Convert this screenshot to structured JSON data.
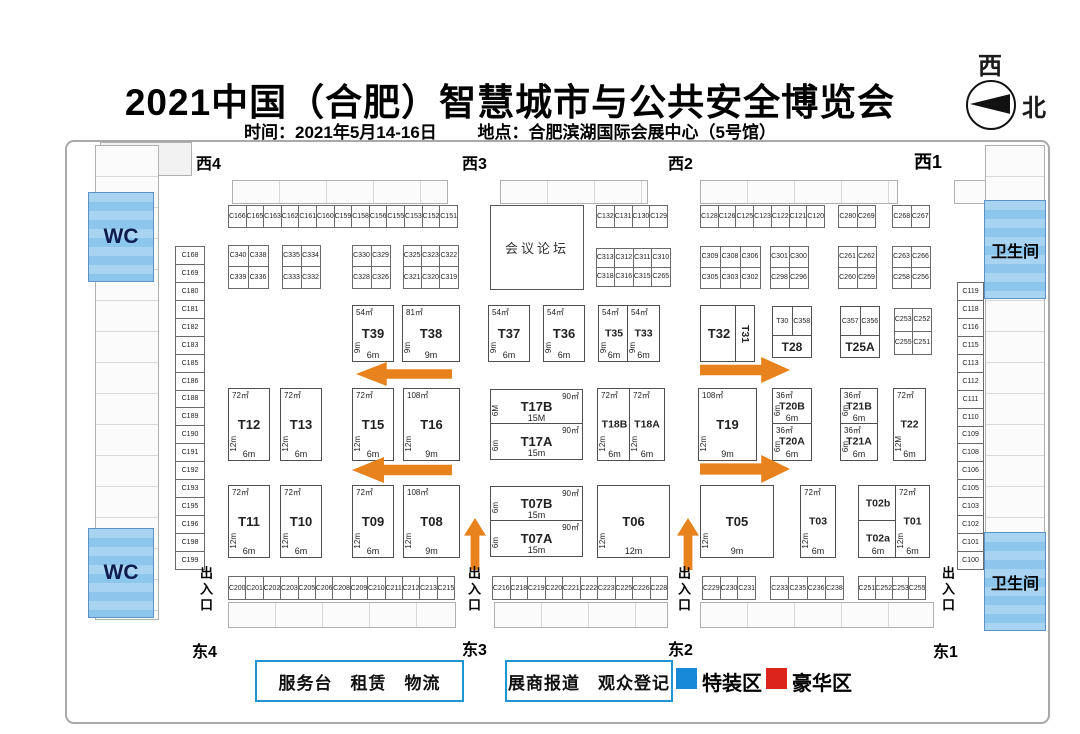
{
  "header": {
    "title": "2021中国（合肥）智慧城市与公共安全博览会",
    "subtitle_time": "时间：2021年5月14-16日",
    "subtitle_place": "地点：合肥滨湖国际会展中心（5号馆）",
    "compass": {
      "west": "西",
      "north": "北"
    }
  },
  "gates": {
    "west4": "西4",
    "west3": "西3",
    "west2": "西2",
    "west1": "西1",
    "east4": "东4",
    "east3": "东3",
    "east2": "东2",
    "east1": "东1"
  },
  "facilities": {
    "wc": "WC",
    "restroom": "卫生间",
    "entrance": "出入口",
    "forum": "会议论坛"
  },
  "legend": {
    "services": "服务台　租赁　物流",
    "registration": "展商报道　观众登记",
    "special_zone": "特装区",
    "deluxe_zone": "豪华区",
    "special_color": "#1789d6",
    "deluxe_color": "#dc241c",
    "box_border_color": "#2095d4"
  },
  "strips": {
    "top1": [
      "C166",
      "C165",
      "C163",
      "C162",
      "C161",
      "C160",
      "C159",
      "C158",
      "C156",
      "C155",
      "C153",
      "C152",
      "C151"
    ],
    "top2": [
      "C132",
      "C131",
      "C130",
      "C129"
    ],
    "top3": [
      "C128",
      "C126",
      "C125",
      "C123",
      "C122",
      "C121",
      "C120"
    ],
    "top4": [
      "C280",
      "C269"
    ],
    "top5": [
      "C268",
      "C267"
    ],
    "left_col": [
      "C168",
      "C169",
      "C180",
      "C181",
      "C182",
      "C183",
      "C185",
      "C186",
      "C188",
      "C189",
      "C190",
      "C191",
      "C192",
      "C193",
      "C195",
      "C196",
      "C198",
      "C199"
    ],
    "right_col": [
      "C119",
      "C118",
      "C116",
      "C115",
      "C113",
      "C112",
      "C111",
      "C110",
      "C109",
      "C108",
      "C106",
      "C105",
      "C103",
      "C102",
      "C101",
      "C100"
    ],
    "bottom1": [
      "C200",
      "C201",
      "C202",
      "C203",
      "C205",
      "C206",
      "C208",
      "C209",
      "C210",
      "C211",
      "C212",
      "C213",
      "C215"
    ],
    "bottom2": [
      "C216",
      "C218",
      "C219",
      "C220",
      "C221",
      "C222",
      "C223",
      "C225",
      "C226",
      "C228"
    ],
    "bottom3": [
      "C229",
      "C230",
      "C231"
    ],
    "bottom4": [
      "C233",
      "C235",
      "C236",
      "C238"
    ],
    "bottom5": [
      "C251",
      "C252",
      "C253",
      "C255"
    ]
  },
  "blocks": {
    "b1": [
      "C340",
      "C338",
      "C339",
      "C336"
    ],
    "b2": [
      "C335",
      "C334",
      "C333",
      "C332"
    ],
    "b3": [
      "C330",
      "C329",
      "C328",
      "C326"
    ],
    "b4": [
      "C325",
      "C323",
      "C322",
      "C321",
      "C320",
      "C319"
    ],
    "b5": [
      "C313",
      "C312",
      "C311",
      "C310",
      "C318",
      "C316",
      "C315",
      "C265"
    ],
    "b6": [
      "C309",
      "C308",
      "C306",
      "C305",
      "C303",
      "C302"
    ],
    "b7": [
      "C301",
      "C300",
      "C298",
      "C296"
    ],
    "b8": [
      "C261",
      "C262",
      "C260",
      "C259"
    ],
    "b9": [
      "C263",
      "C266",
      "C258",
      "C256"
    ],
    "c253": [
      "C253",
      "C252",
      "C255",
      "C251"
    ]
  },
  "mid": {
    "t30": "T30",
    "c358": "C358",
    "t28": "T28",
    "c357": "C357",
    "c356": "C356",
    "t25a": "T25A"
  },
  "booths": {
    "T39": {
      "id": "T39",
      "area": "54㎡",
      "side": "9m",
      "bottom": "6m"
    },
    "T38": {
      "id": "T38",
      "area": "81㎡",
      "side": "9m",
      "bottom": "9m"
    },
    "T37": {
      "id": "T37",
      "area": "54㎡",
      "side": "9m",
      "bottom": "6m"
    },
    "T36": {
      "id": "T36",
      "area": "54㎡",
      "side": "9m",
      "bottom": "6m"
    },
    "T35": {
      "id": "T35",
      "area": "54㎡",
      "side": "9m",
      "bottom": "6m"
    },
    "T33": {
      "id": "T33",
      "area": "54㎡",
      "side": "9m",
      "bottom": "6m"
    },
    "T32": {
      "id": "T32"
    },
    "T31": {
      "id": "T31"
    },
    "T12": {
      "id": "T12",
      "area": "72㎡",
      "side": "12m",
      "bottom": "6m"
    },
    "T13": {
      "id": "T13",
      "area": "72㎡",
      "side": "12m",
      "bottom": "6m"
    },
    "T15": {
      "id": "T15",
      "area": "72㎡",
      "side": "12m",
      "bottom": "6m"
    },
    "T16": {
      "id": "T16",
      "area": "108㎡",
      "side": "12m",
      "bottom": "9m"
    },
    "T17B": {
      "id": "T17B",
      "area": "90㎡",
      "side": "6M",
      "bottom": "15M"
    },
    "T17A": {
      "id": "T17A",
      "area": "90㎡",
      "side": "6m",
      "bottom": "15m"
    },
    "T18B": {
      "id": "T18B",
      "area": "72㎡",
      "side": "12m",
      "bottom": "6m"
    },
    "T18A": {
      "id": "T18A",
      "area": "72㎡",
      "side": "12m",
      "bottom": "6m"
    },
    "T19": {
      "id": "T19",
      "area": "108㎡",
      "side": "12m",
      "bottom": "9m"
    },
    "T20B": {
      "id": "T20B",
      "area": "36㎡",
      "side": "6m",
      "bottom": "6m"
    },
    "T20A": {
      "id": "T20A",
      "area": "36㎡",
      "side": "6m",
      "bottom": "6m"
    },
    "T21B": {
      "id": "T21B",
      "area": "36㎡",
      "side": "6m",
      "bottom": "6m"
    },
    "T21A": {
      "id": "T21A",
      "area": "36㎡",
      "side": "6m",
      "bottom": "6m"
    },
    "T22": {
      "id": "T22",
      "area": "72㎡",
      "side": "12M",
      "bottom": "6m"
    },
    "T11": {
      "id": "T11",
      "area": "72㎡",
      "side": "12m",
      "bottom": "6m"
    },
    "T10": {
      "id": "T10",
      "area": "72㎡",
      "side": "12m",
      "bottom": "6m"
    },
    "T09": {
      "id": "T09",
      "area": "72㎡",
      "side": "12m",
      "bottom": "6m"
    },
    "T08": {
      "id": "T08",
      "area": "108㎡",
      "side": "12m",
      "bottom": "9m"
    },
    "T07B": {
      "id": "T07B",
      "area": "90㎡",
      "side": "6m",
      "bottom": "15m"
    },
    "T07A": {
      "id": "T07A",
      "area": "90㎡",
      "side": "6m",
      "bottom": "15m"
    },
    "T06": {
      "id": "T06",
      "side": "12m",
      "bottom": "12m"
    },
    "T05": {
      "id": "T05",
      "side": "12m",
      "bottom": "9m"
    },
    "T03": {
      "id": "T03",
      "area": "72㎡",
      "side": "12m",
      "bottom": "6m"
    },
    "T02b": {
      "id": "T02b"
    },
    "T02a": {
      "id": "T02a",
      "bottom": "6m"
    },
    "T01": {
      "id": "T01",
      "area": "72㎡",
      "side": "12m",
      "bottom": "6m"
    }
  }
}
